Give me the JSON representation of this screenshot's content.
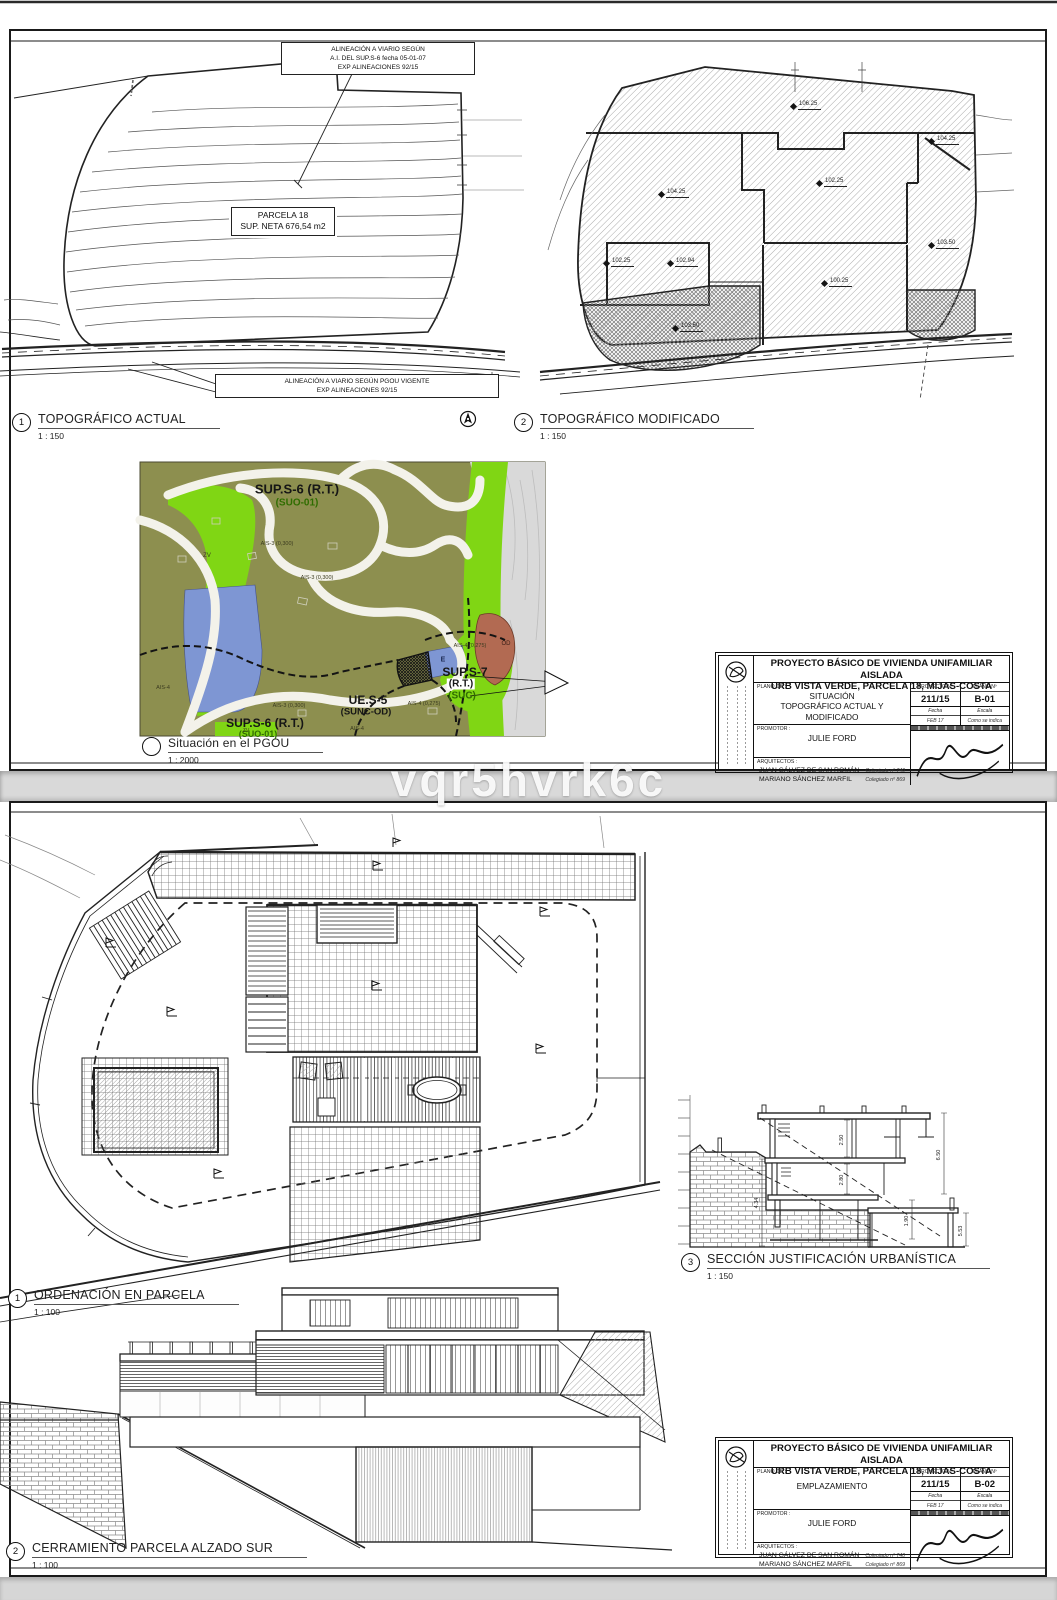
{
  "page": {
    "watermark": "vqr5hvrk6c"
  },
  "colors": {
    "paper": "#ffffff",
    "line": "#1a1a1a",
    "pgou_olive": "#8d8f4f",
    "pgou_green": "#80d614",
    "pgou_blue": "#7e96d3",
    "pgou_brown": "#b26a52",
    "pgou_gray": "#d9d9d9"
  },
  "sheet1": {
    "callout_top": "ALINEACIÓN A VIARIO SEGÚN\nA.I. DEL SUP.S-6 fecha 05-01-07\nEXP ALINEACIONES 92/15",
    "parcel_box": "PARCELA 18\nSUP. NETA 676,54 m2",
    "callout_bottom": "ALINEACIÓN A VIARIO SEGÚN PGOU VIGENTE\nEXP ALINEACIONES 92/15",
    "view1": {
      "num": "1",
      "title": "TOPOGRÁFICO ACTUAL",
      "scale": "1 : 150"
    },
    "view2": {
      "num": "2",
      "title": "TOPOGRÁFICO MODIFICADO",
      "scale": "1 : 150"
    },
    "pgou_view": {
      "title": "Situación en el PGOU",
      "scale": "1 : 2000"
    },
    "spots": {
      "s1": "106.25",
      "s2": "104.25",
      "s3": "102.25",
      "s4": "104.25",
      "s5": "103.50",
      "s6": "102.25",
      "s7": "102.94",
      "s8": "100.25",
      "s9": "103.50"
    },
    "pgou": {
      "sup_s6_top": "SUP.S-6 (R.T.)",
      "suo01_top": "(SUO-01)",
      "zv_top": "ZV",
      "ais3_a": "AIS-3 (0,300)",
      "ais3_b": "AIS-3 (0,300)",
      "ais3_c": "AIS-3 (0,300)",
      "sup_s7": "SUP.S-7",
      "rt": "(R.T.)",
      "suc": "(SUC)",
      "ues5": "UE.S-5",
      "sunc_od": "(SUNC-OD)",
      "ais4_a": "AIS-4 (0,275)",
      "ais4_b": "AIS-4 (0,275)",
      "sup_s6_bot": "SUP.S-6 (R.T.)",
      "suo01_bot": "(SUO-01)",
      "ais4_c": "AIS-4",
      "ais4_d": "AIS-4",
      "e_label": "E",
      "od_label": "OD",
      "zv_bot": "ZV"
    }
  },
  "sheet2": {
    "view1": {
      "num": "1",
      "title": "ORDENACIÓN EN PARCELA",
      "scale": "1 : 100"
    },
    "view3": {
      "num": "3",
      "title": "SECCIÓN JUSTIFICACIÓN URBANÍSTICA",
      "scale": "1 : 150"
    },
    "view2": {
      "num": "2",
      "title": "CERRAMIENTO PARCELA ALZADO SUR",
      "scale": "1 : 100"
    },
    "section_dims": {
      "d1": "2.50",
      "d2": "2.80",
      "d3": "6.50",
      "d4": "1.90",
      "d5": "5.53",
      "d6": "4.34"
    }
  },
  "titleblock": {
    "title1": "PROYECTO BÁSICO DE VIVIENDA UNIFAMILIAR AISLADA",
    "title2": "URB VISTA VERDE, PARCELA 18, MIJAS-COSTA",
    "plano_de_label": "PLANO DE :",
    "promotor_label": "PROMOTOR :",
    "promotor": "JULIE FORD",
    "arquitectos_label": "ARQUITECTOS :",
    "arquitecto1": "JUAN GÁLVEZ DE SAN ROMÁN",
    "arquitecto2": "MARIANO SÁNCHEZ MARFIL",
    "colegiado1": "Colegiado nº 740",
    "colegiado2": "Colegiado nº 869",
    "proyecto_label": "PROYECTO Nº",
    "plano_label": "PLANO Nº",
    "proyecto_num": "211/15",
    "fecha_label": "Fecha",
    "escala_label": "Escala",
    "fecha": "FEB 17",
    "escala": "Como se indica"
  },
  "titleblock1": {
    "plano_de": "SITUACIÓN\nTOPOGRÁFICO ACTUAL Y MODIFICADO",
    "plano_num": "B-01"
  },
  "titleblock2": {
    "plano_de": "EMPLAZAMIENTO",
    "plano_num": "B-02"
  }
}
